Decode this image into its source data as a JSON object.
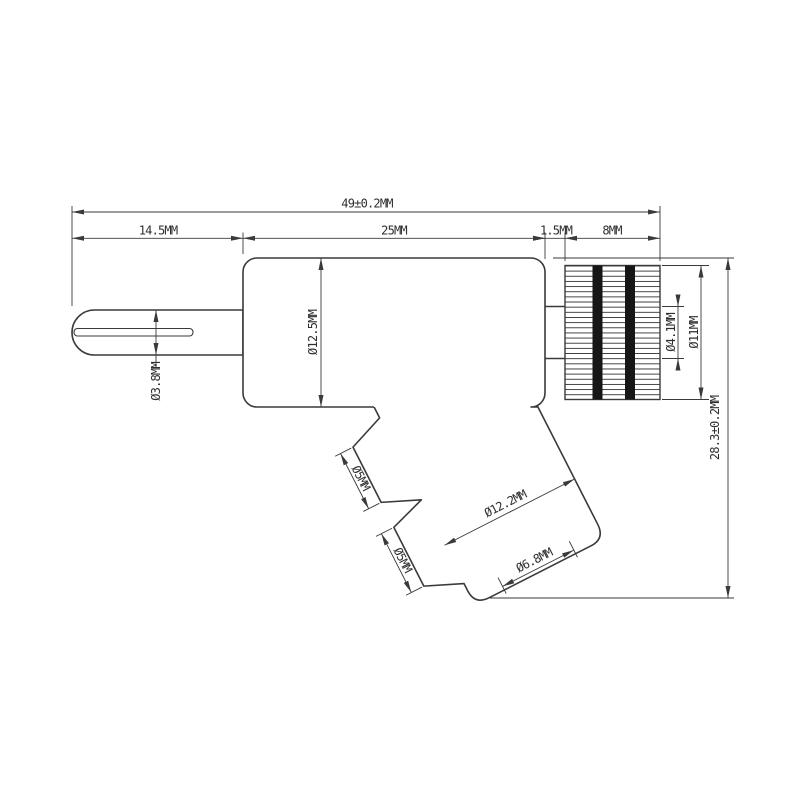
{
  "drawing": {
    "type": "2D technical dimension drawing",
    "background_color": "#ffffff",
    "line_color": "#3a3a3a",
    "fin_bar_color": "#161616",
    "dimensions": {
      "overall_length": "49±0.2MM",
      "plug_length": "14.5MM",
      "body_length": "25MM",
      "collar_gap": "1.5MM",
      "heatsink_length": "8MM",
      "plug_diameter": "Ø3.8MM",
      "body_diameter": "Ø12.5MM",
      "shaft_diameter": "Ø4.1MM",
      "heatsink_diameter": "Ø11MM",
      "overall_height": "28.3±0.2MM",
      "upper_button_diameter": "Ø5MM",
      "lower_button_diameter": "Ø5MM",
      "handle_diameter": "Ø12.2MM",
      "handle_tip_diameter": "Ø6.8MM"
    }
  }
}
